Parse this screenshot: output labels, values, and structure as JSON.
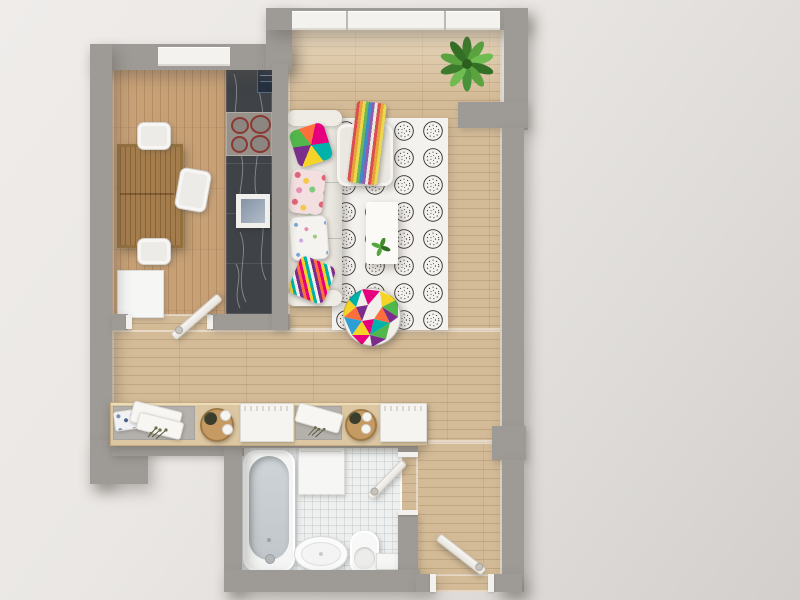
{
  "scene": {
    "title": "3D top-view floor plan of a small apartment",
    "rooms": [
      {
        "name": "kitchen-dining-room",
        "floor": "wood",
        "furniture": [
          "dining-table",
          "three-white-chairs",
          "marble-counter",
          "cooktop",
          "square-sink",
          "white-cabinet"
        ]
      },
      {
        "name": "living-room",
        "floor": "wood",
        "furniture": [
          "white-sofa",
          "chaise-lounge",
          "patterned-rug",
          "coffee-table",
          "multicolor-pouf",
          "corner-plant",
          "striped-throw-blanket",
          "four-colorful-pillows"
        ]
      },
      {
        "name": "hallway",
        "floor": "wood",
        "furniture": [
          "console-sideboard",
          "folded-towels",
          "round-trays",
          "dried-plants",
          "storage-boxes"
        ]
      },
      {
        "name": "bathroom",
        "floor": "white-tile",
        "furniture": [
          "bathtub",
          "washer-cabinet",
          "oval-basin",
          "toilet",
          "small-shelf"
        ]
      }
    ],
    "doors": [
      "kitchen-hallway-door",
      "bathroom-door",
      "entry-door"
    ],
    "windows": [
      "living-room-north-window",
      "kitchen-north-window"
    ],
    "palette": {
      "exterior": "#e9e6e2",
      "wall": "#9e9a96",
      "wood_light": "#d4bb97",
      "wood_kitchen": "#c7a076",
      "counter_marble": "#3f4347",
      "fixture_white": "#f5f4f1",
      "tile": "#eef0ef",
      "accent_pink": "#e6007e",
      "accent_teal": "#00b2a9",
      "accent_yellow": "#f5d327",
      "accent_purple": "#7b2d8b",
      "accent_green": "#51b74b",
      "accent_orange": "#ff6f3c",
      "plant_green": "#4e8f3c"
    }
  }
}
